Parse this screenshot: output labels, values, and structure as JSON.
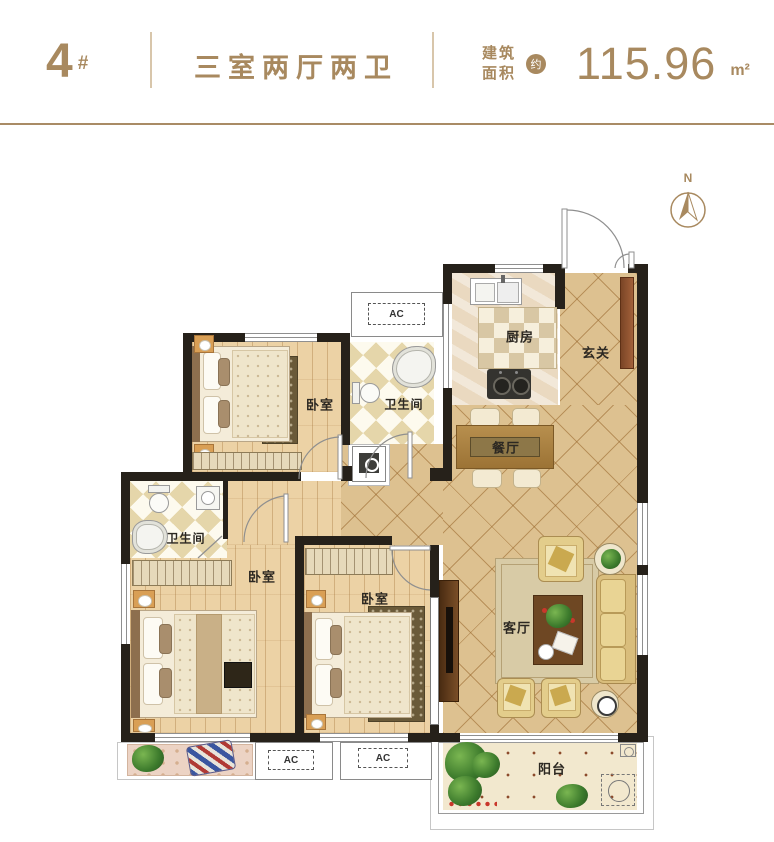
{
  "header": {
    "block_number": "4",
    "block_suffix": "#",
    "layout_title": "三室两厅两卫",
    "area_label_1": "建筑",
    "area_label_2": "面积",
    "area_approx": "约",
    "area_value": "115.96",
    "area_unit": "m²"
  },
  "compass": {
    "north_label": "N"
  },
  "rooms": {
    "bedroom_top": "卧室",
    "bath_top": "卫生间",
    "kitchen": "厨房",
    "entry": "玄关",
    "dining": "餐厅",
    "living": "客厅",
    "bath_left": "卫生间",
    "bedroom_master": "卧室",
    "bedroom_bottom": "卧室",
    "balcony": "阳台"
  },
  "annotations": {
    "ac": "AC"
  },
  "colors": {
    "accent": "#a8895f",
    "wall": "#26211a",
    "tile": "#ddc190"
  }
}
